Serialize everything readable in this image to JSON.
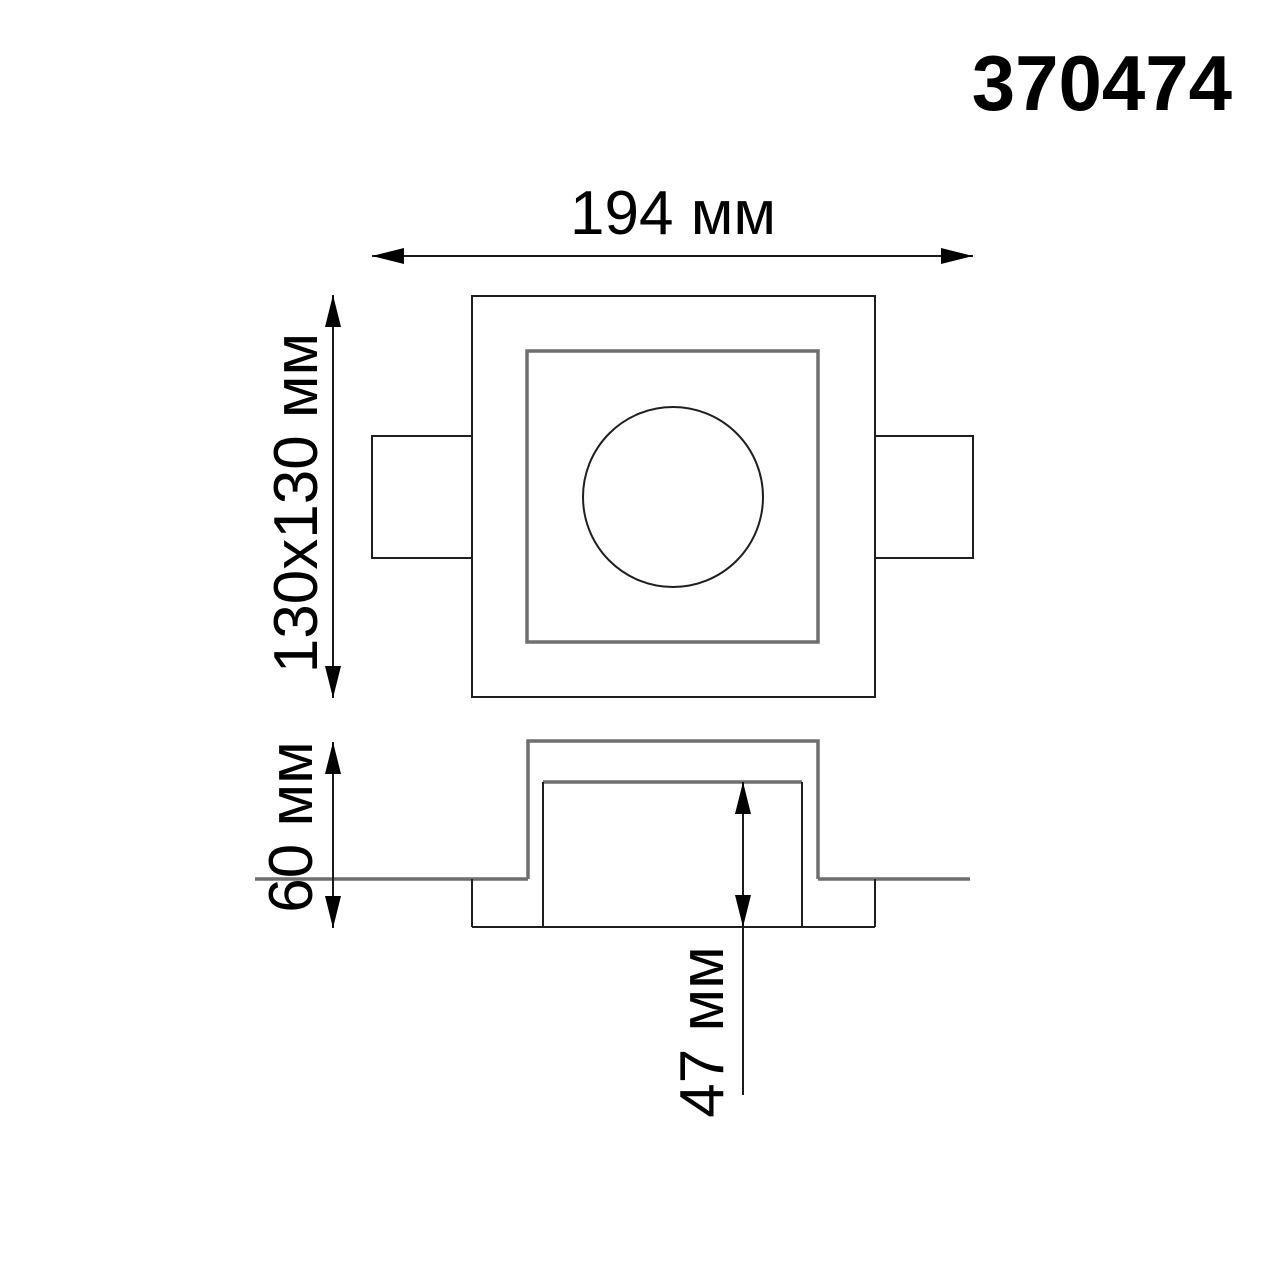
{
  "product": {
    "code": "370474"
  },
  "dimensions": {
    "overall_width": {
      "label": "194 мм",
      "value_mm": 194
    },
    "cutout": {
      "label": "130x130 мм",
      "value": "130x130"
    },
    "overall_height": {
      "label": "60 мм",
      "value_mm": 60
    },
    "recess_depth": {
      "label": "47 мм",
      "value_mm": 47
    }
  }
}
